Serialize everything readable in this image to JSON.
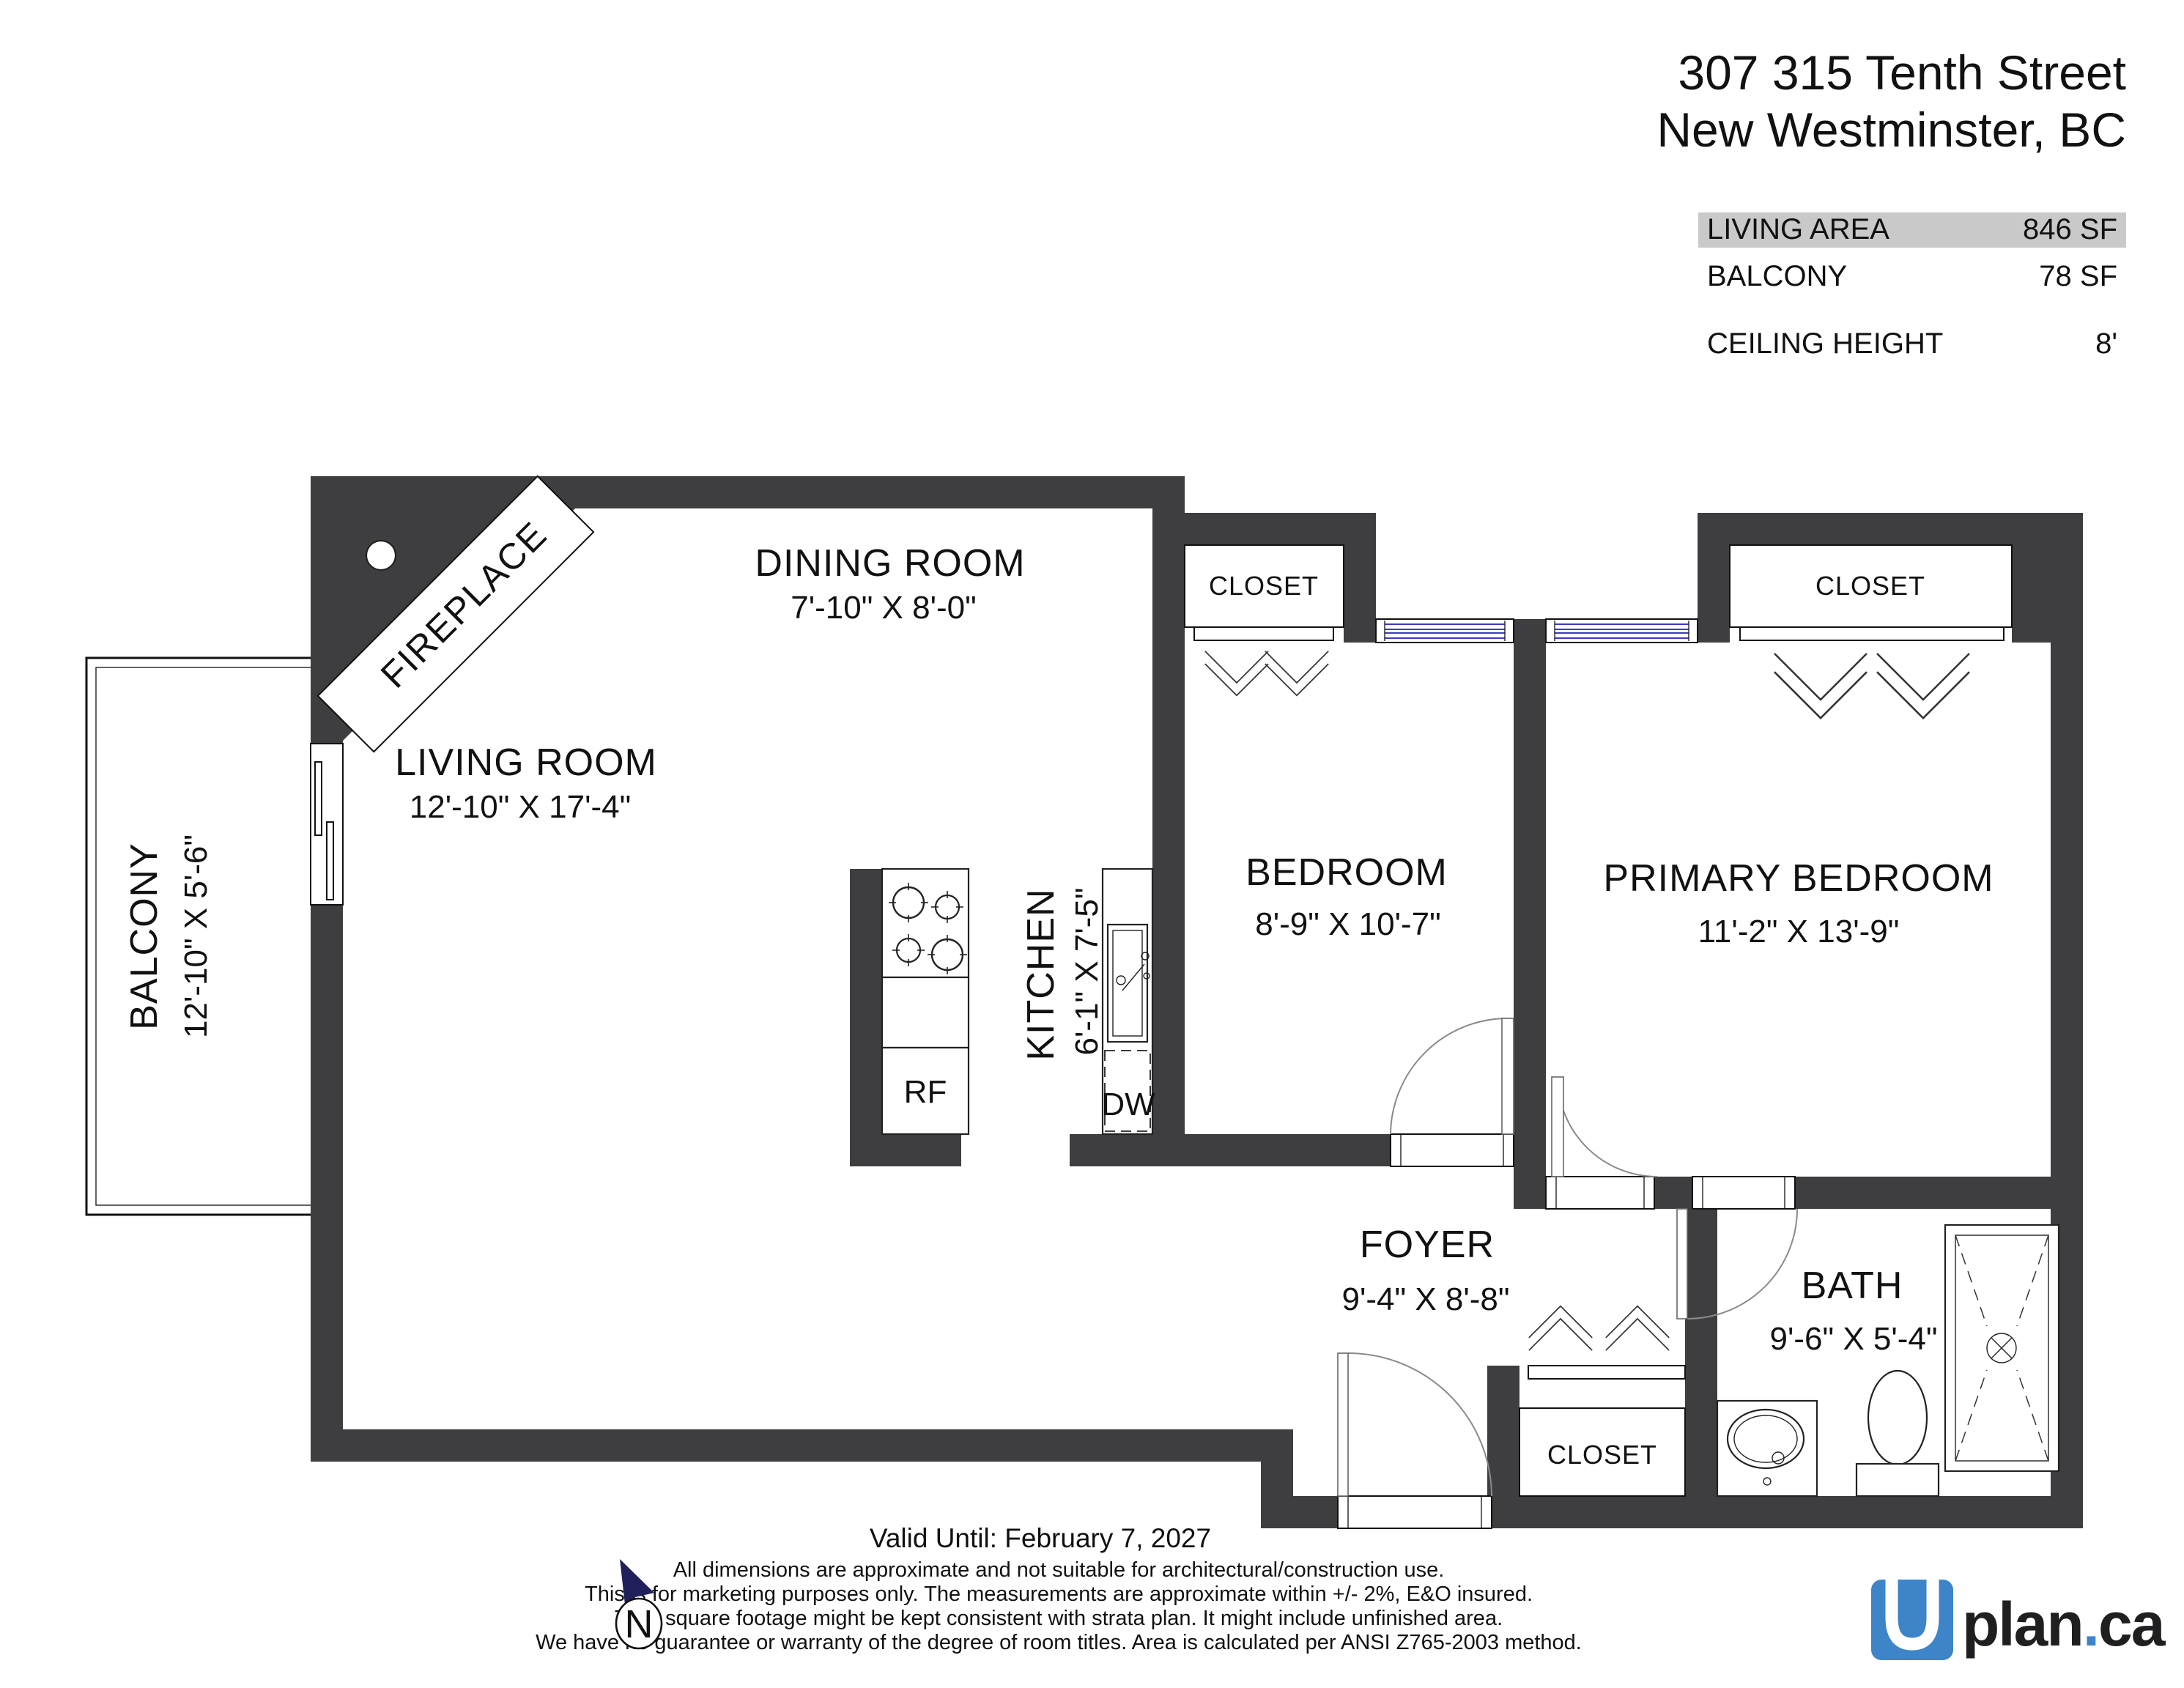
{
  "header": {
    "address_line1": "307 315 Tenth Street",
    "address_line2": "New Westminster, BC"
  },
  "area_table": {
    "rows": [
      {
        "label": "LIVING AREA",
        "value": "846 SF"
      },
      {
        "label": "BALCONY",
        "value": "78 SF"
      },
      {
        "label": "CEILING HEIGHT",
        "value": "8'"
      }
    ]
  },
  "rooms": {
    "living": {
      "name": "LIVING ROOM",
      "dims": "12'-10\" X 17'-4\""
    },
    "dining": {
      "name": "DINING ROOM",
      "dims": "7'-10\" X 8'-0\""
    },
    "kitchen": {
      "name": "KITCHEN",
      "dims": "6'-1\" X 7'-5\""
    },
    "bedroom": {
      "name": "BEDROOM",
      "dims": "8'-9\" X 10'-7\""
    },
    "primary_bedroom": {
      "name": "PRIMARY BEDROOM",
      "dims": "11'-2\" X 13'-9\""
    },
    "foyer": {
      "name": "FOYER",
      "dims": "9'-4\" X 8'-8\""
    },
    "bath": {
      "name": "BATH",
      "dims": "9'-6\" X 5'-4\""
    },
    "balcony": {
      "name": "BALCONY",
      "dims": "12'-10\" X 5'-6\""
    }
  },
  "labels": {
    "closet": "CLOSET",
    "fireplace": "FIREPLACE",
    "fridge": "RF",
    "dishwasher": "DW",
    "north": "N"
  },
  "footer": {
    "valid_until": "Valid Until: February 7, 2027",
    "disclaimer_lines": [
      "All dimensions are approximate and not suitable for architectural/construction use.",
      "This is for marketing purposes only. The measurements are approximate within +/- 2%, E&O insured.",
      "Total square footage might be kept consistent with strata plan. It might include unfinished area.",
      "We have no guarantee or warranty of the degree of room titles. Area is calculated per ANSI Z765-2003 method."
    ],
    "logo": {
      "u": "U",
      "plan": "plan",
      "dot": ".",
      "ca": "ca"
    }
  },
  "colors": {
    "wall": "#3e3e40",
    "window": "#3c3cbe",
    "highlight": "#c9c9c9",
    "logo_blue": "#3d85c8",
    "flag": "#20205a"
  }
}
